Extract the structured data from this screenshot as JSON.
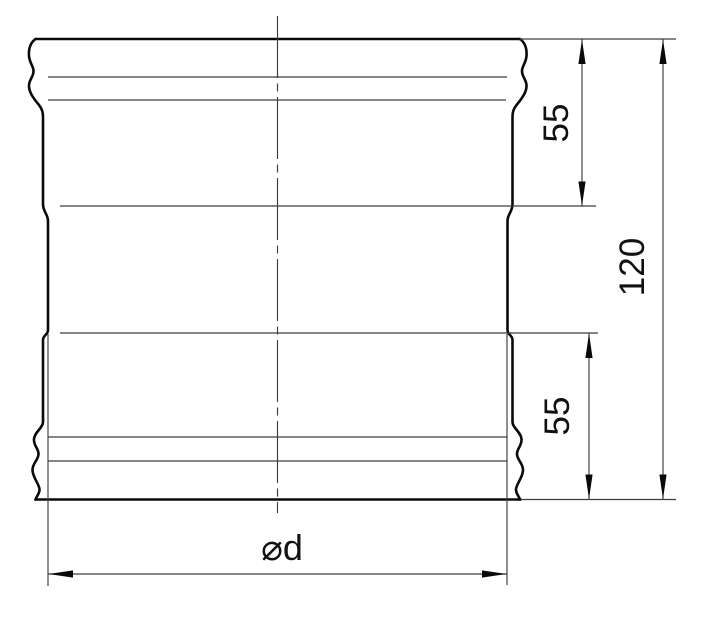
{
  "drawing": {
    "kind": "engineering-dimension-diagram",
    "background_color": "#ffffff",
    "outline_color": "#0a0a0a",
    "thin_line_color": "#3d3d3d",
    "text_color": "#111111",
    "dimensions": {
      "top_socket_depth": {
        "label": "55",
        "orientation": "vertical-rotated"
      },
      "bottom_socket_depth": {
        "label": "55",
        "orientation": "vertical-rotated"
      },
      "overall_length": {
        "label": "120",
        "orientation": "vertical-rotated"
      },
      "diameter": {
        "label": "⌀d",
        "orientation": "horizontal"
      }
    }
  }
}
